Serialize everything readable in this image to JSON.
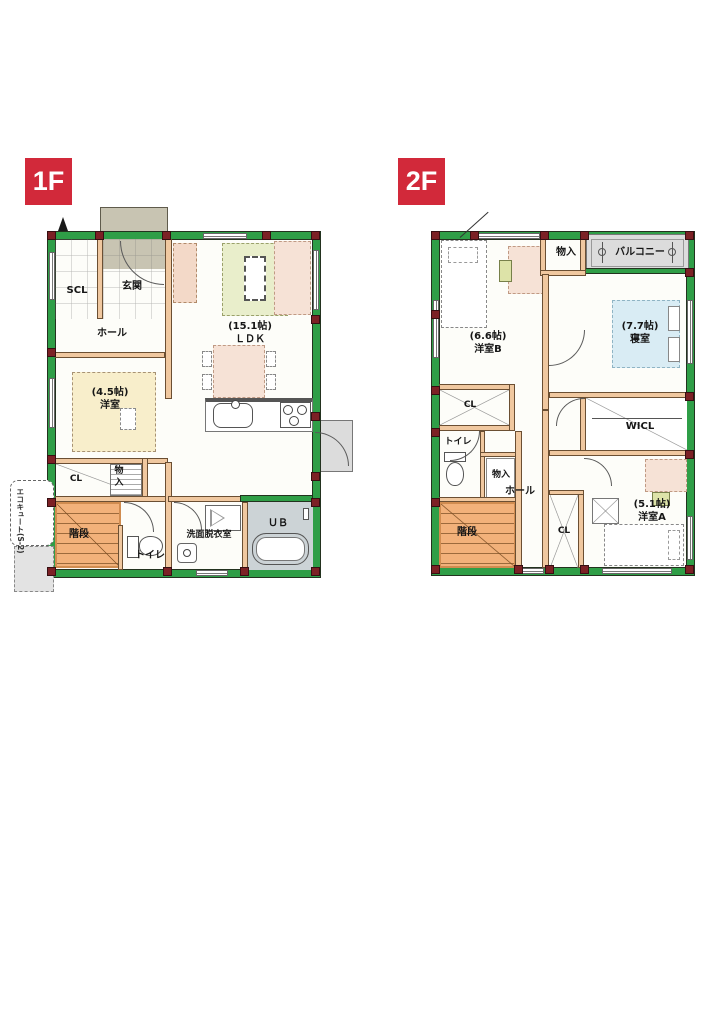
{
  "badges": {
    "floor1": "1F",
    "floor2": "2F"
  },
  "floor1": {
    "labels": {
      "scl": "SCL",
      "genkan": "玄関",
      "hall": "ホール",
      "youshitsu45": "(4.5帖)\n洋室",
      "ldk": "(15.1帖)\nＬＤＫ",
      "cl": "CL",
      "monoire": "物入",
      "kaidan": "階段",
      "toilet": "トイレ",
      "senmen": "洗面脱衣室",
      "ub": "ＵＢ",
      "ecocute": "エコキュート(S-2)"
    }
  },
  "floor2": {
    "labels": {
      "monoire_top": "物入",
      "balcony": "バルコニー",
      "youshitsuB": "(6.6帖)\n洋室B",
      "shinshitsu": "(7.7帖)\n寝室",
      "cl_upper": "CL",
      "wicl": "WICL",
      "toilet": "トイレ",
      "monoire_mid": "物入",
      "hall": "ホール",
      "kaidan": "階段",
      "cl_lower": "CL",
      "youshitsuA": "(5.1帖)\n洋室A"
    }
  },
  "colors": {
    "badge_red": "#d2293a",
    "wall_green": "#2f9e47",
    "pillar_maroon": "#7c2125",
    "interior_wall_peach": "#f0c8a0",
    "stairs_orange": "#f2b17a",
    "tatami_rug_beige": "#f8eecb",
    "ldk_rug_green": "#e9eecb",
    "bed_blue": "#d9ecf4",
    "furniture_pink": "#f6e2d6",
    "bath_gray": "#ccd3d6",
    "balcony_gray": "#dcdcdc",
    "porch_gray": "#c8c4b2"
  }
}
